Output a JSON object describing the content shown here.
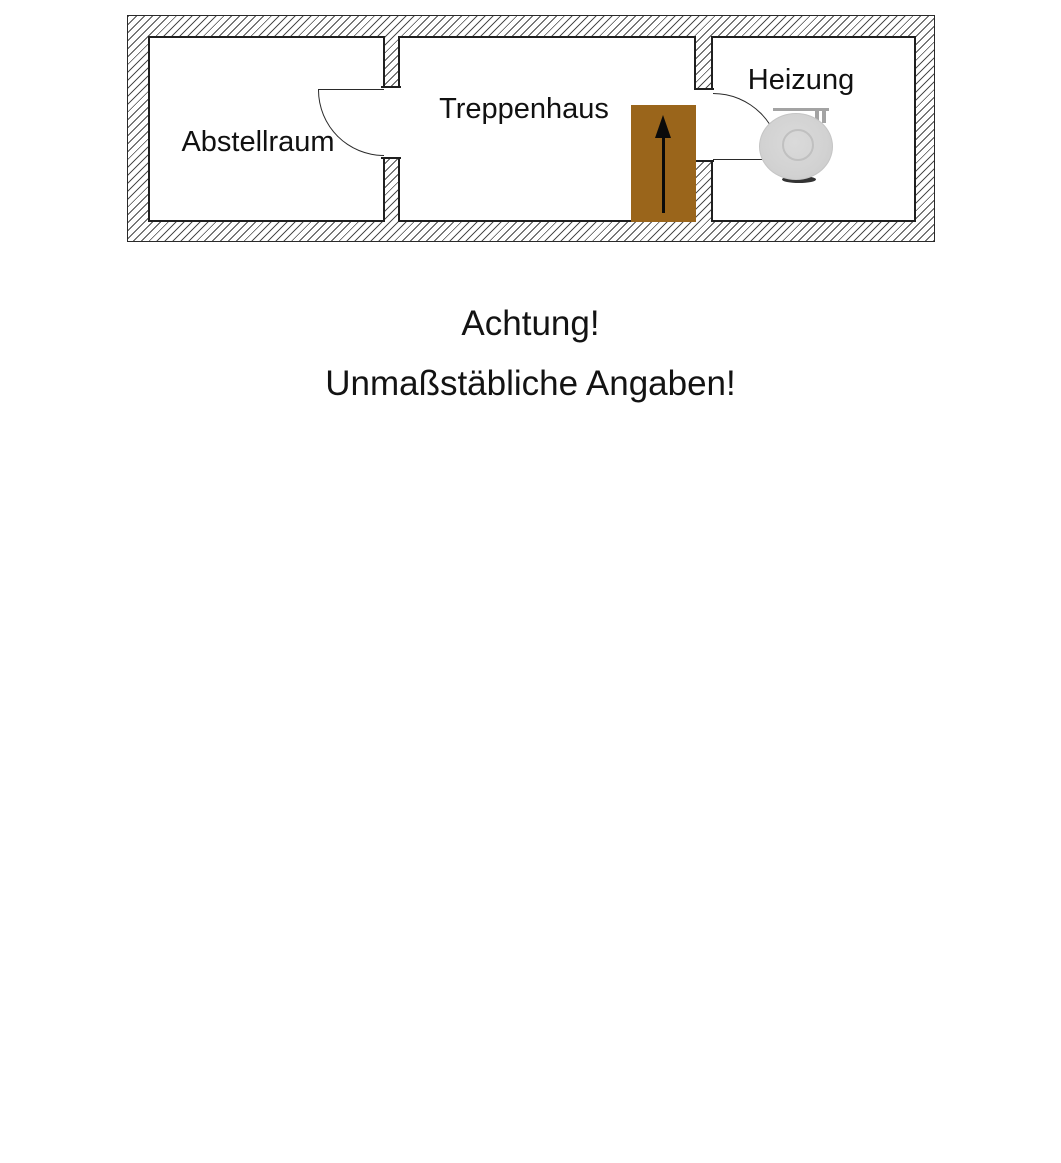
{
  "floorplan": {
    "rooms": [
      {
        "id": "abstellraum",
        "label": "Abstellraum"
      },
      {
        "id": "treppenhaus",
        "label": "Treppenhaus"
      },
      {
        "id": "heizung",
        "label": "Heizung"
      }
    ],
    "icons": {
      "stairs_direction": "up-arrow"
    },
    "colors": {
      "stairs_brown": "#9a651b",
      "boiler_gray": "#d2d2d2",
      "wall_hatch_line": "#2d2d2d",
      "outline_black": "#1f1f1f"
    }
  },
  "caption": {
    "line1": "Achtung!",
    "line2": "Unmaßstäbliche Angaben!"
  }
}
